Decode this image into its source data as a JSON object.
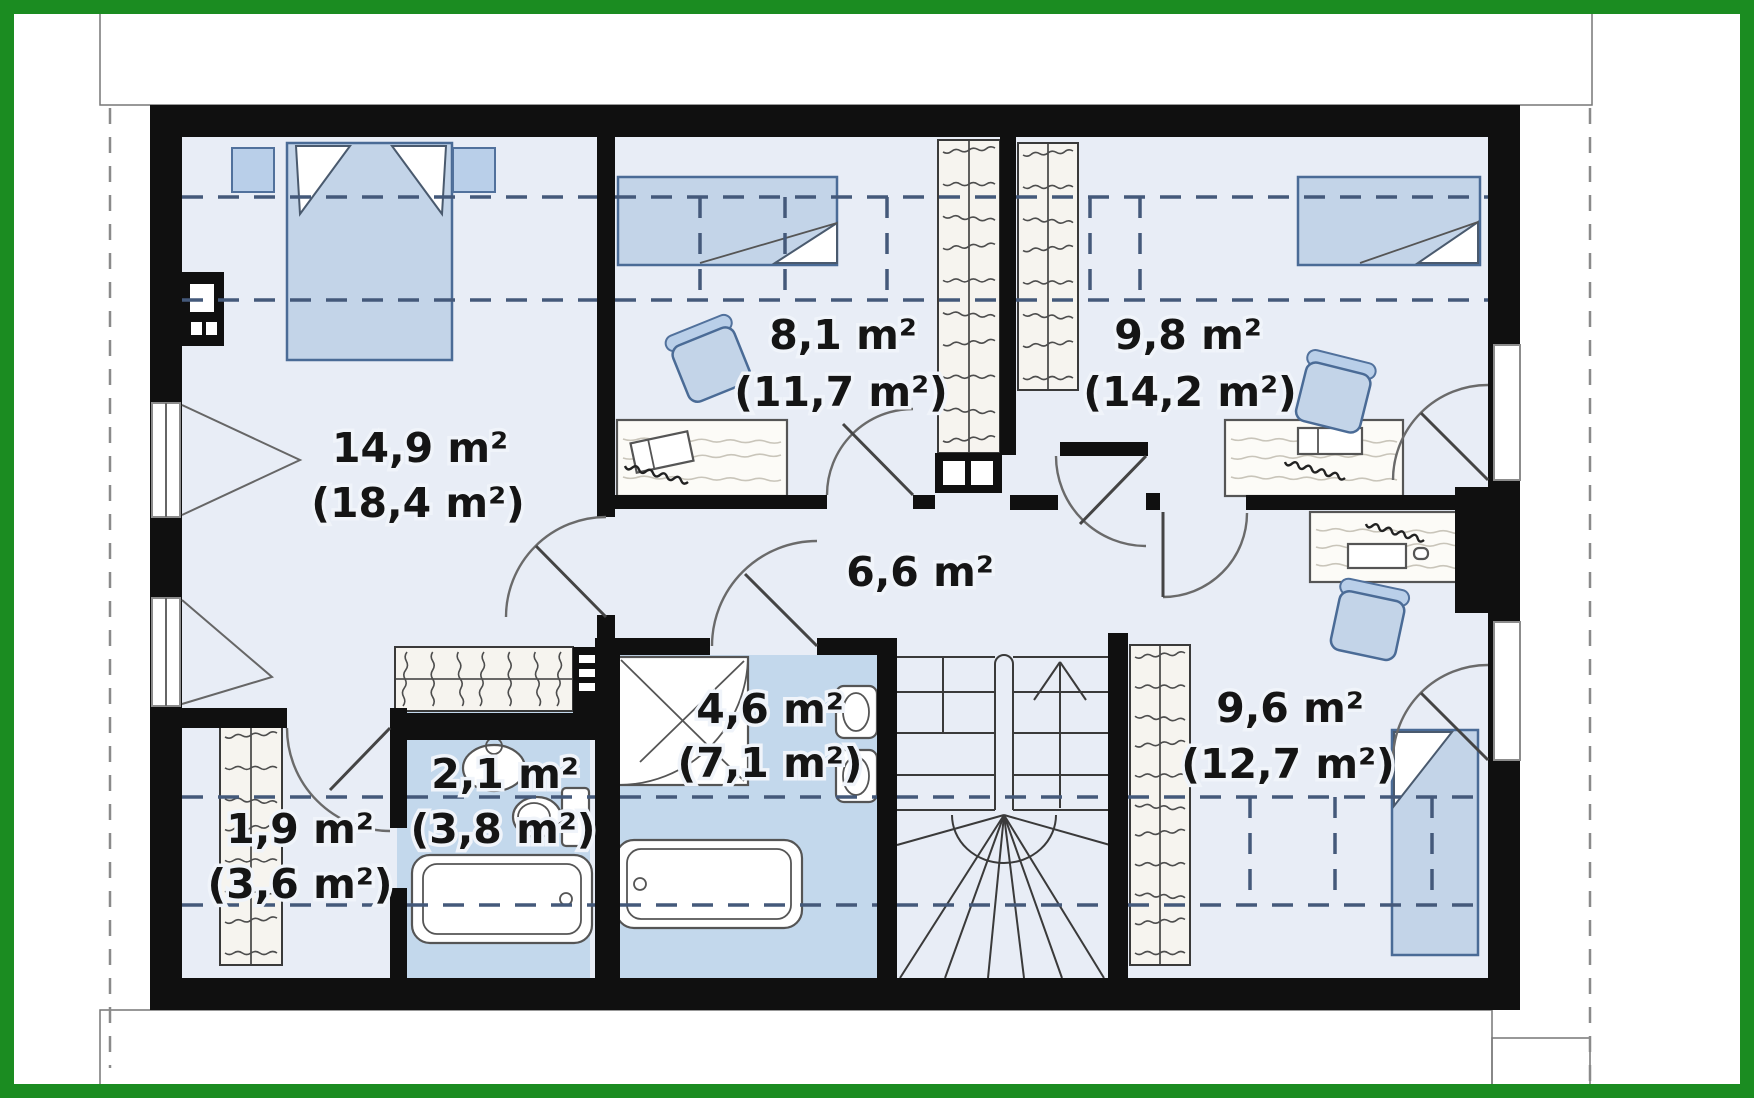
{
  "plan": {
    "type": "attic-floor-plan",
    "rooms": [
      {
        "key": "bedroom-main",
        "area": "14,9 m²",
        "area_total": "(18,4 m²)"
      },
      {
        "key": "bedroom-2",
        "area": "8,1 m²",
        "area_total": "(11,7 m²)"
      },
      {
        "key": "bedroom-3",
        "area": "9,8 m²",
        "area_total": "(14,2 m²)"
      },
      {
        "key": "hallway",
        "area": "6,6 m²",
        "area_total": ""
      },
      {
        "key": "bathroom",
        "area": "4,6 m²",
        "area_total": "(7,1 m²)"
      },
      {
        "key": "toilet",
        "area": "2,1 m²",
        "area_total": "(3,8 m²)"
      },
      {
        "key": "closet",
        "area": "1,9 m²",
        "area_total": "(3,6 m²)"
      },
      {
        "key": "bedroom-4",
        "area": "9,6 m²",
        "area_total": "(12,7 m²)"
      }
    ],
    "colors": {
      "frame_green": "#1b8c21",
      "walls": "#101010",
      "room_floor": "#e8edf6",
      "wet_room_floor": "#c3d8ec",
      "furniture_blue": "#c3d4e8",
      "label_text": "#151515"
    }
  }
}
